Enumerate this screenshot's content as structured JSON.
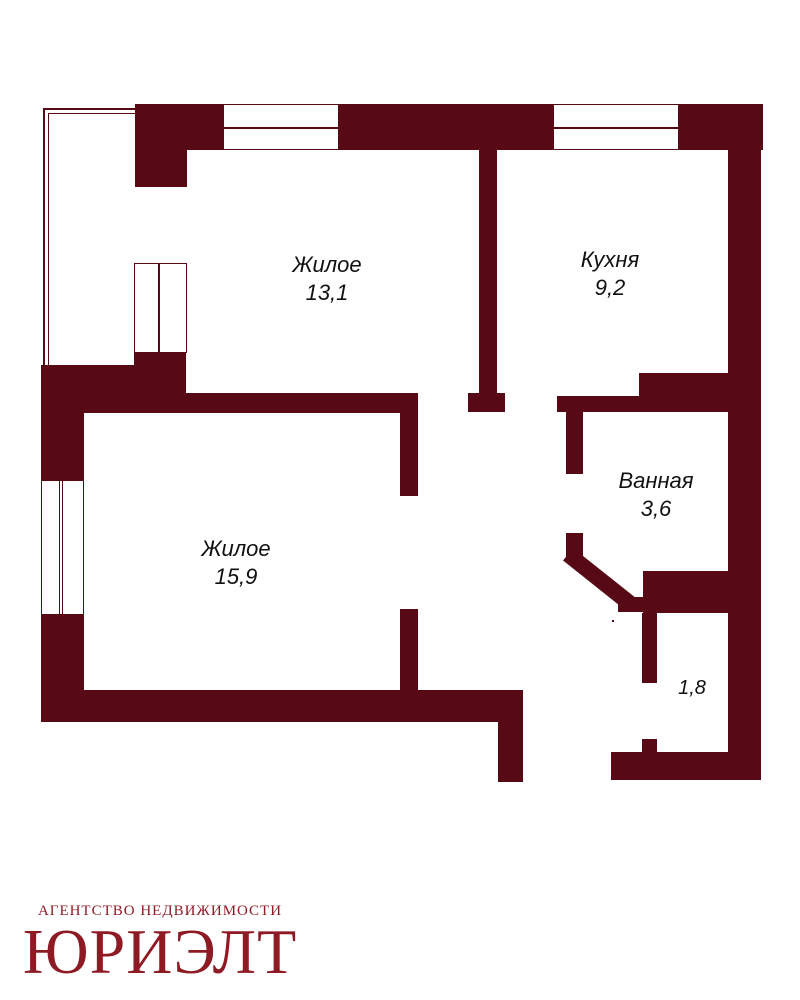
{
  "colors": {
    "wall": "#570a15",
    "logo": "#8e1b24",
    "text": "#111111",
    "bg": "#ffffff"
  },
  "rooms": [
    {
      "name": "Жилое",
      "area": "13,1"
    },
    {
      "name": "Кухня",
      "area": "9,2"
    },
    {
      "name": "Ванная",
      "area": "3,6"
    },
    {
      "name": "Жилое",
      "area": "15,9"
    },
    {
      "name": "",
      "area": "1,8"
    }
  ],
  "brand": {
    "tagline": "АГЕНТСТВО НЕДВИЖИМОСТИ",
    "name": "ЮРИЭЛТ"
  }
}
